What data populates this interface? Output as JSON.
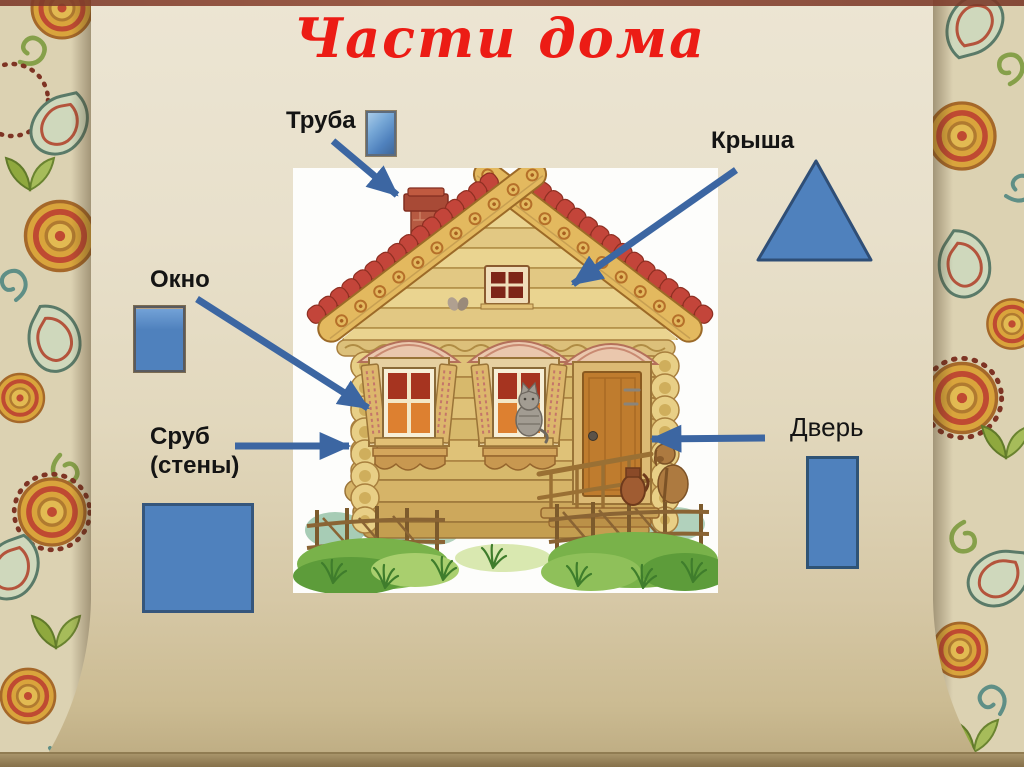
{
  "slide": {
    "title": "Части дома",
    "parts": [
      {
        "id": "chimney",
        "label": "Труба",
        "shape": "small-rectangle"
      },
      {
        "id": "roof",
        "label": "Крыша",
        "shape": "triangle"
      },
      {
        "id": "window",
        "label": "Окно",
        "shape": "rectangle"
      },
      {
        "id": "walls",
        "label_line1": "Сруб",
        "label_line2": "(стены)",
        "shape": "square"
      },
      {
        "id": "door",
        "label": "Дверь",
        "shape": "tall-rectangle"
      }
    ],
    "colors": {
      "title_red": "#ec1c15",
      "shape_blue": "#4f81bd",
      "shape_border_blue": "#2f4e76",
      "arrow_blue": "#3c66a2",
      "background_parchment": "#e6ddc6",
      "label_black": "#141414"
    },
    "illustration": "russian-log-house"
  }
}
